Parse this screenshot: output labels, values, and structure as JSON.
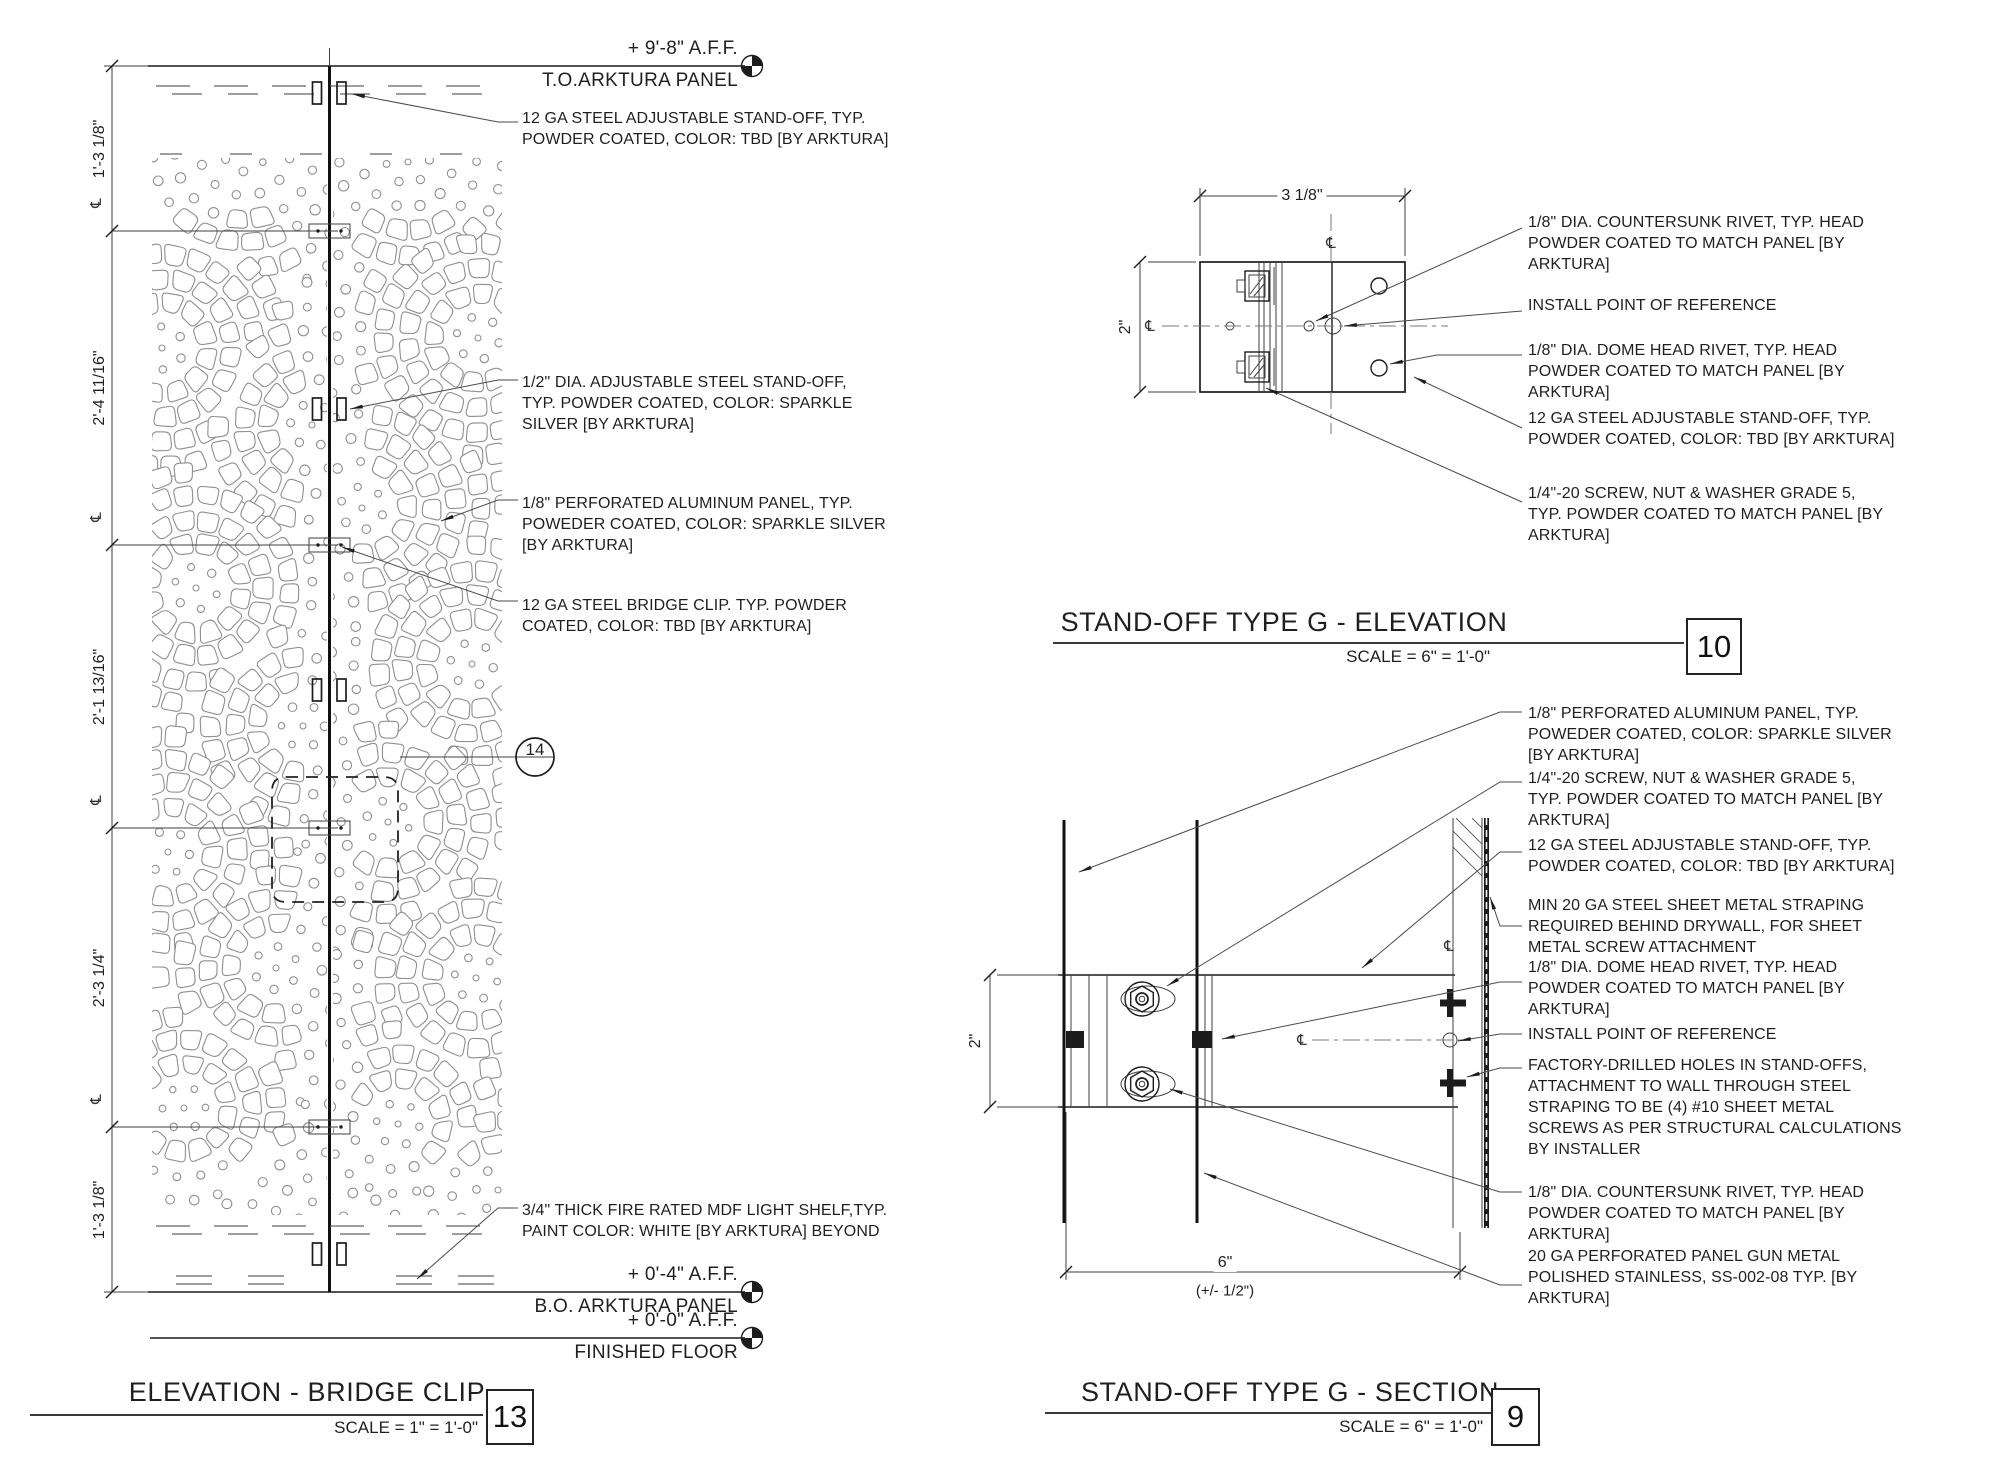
{
  "symbols": {
    "centerline": "℄"
  },
  "bridge_clip": {
    "title": "ELEVATION - BRIDGE CLIP",
    "scale": "SCALE = 1\" = 1'-0\"",
    "number": "13",
    "detail_bubble": "14",
    "levels": [
      {
        "elevation": "+ 9'-8\" A.F.F.",
        "label": "T.O.ARKTURA PANEL"
      },
      {
        "elevation": "+ 0'-4\" A.F.F.",
        "label": "B.O. ARKTURA PANEL"
      },
      {
        "elevation": "+ 0'-0\" A.F.F.",
        "label": "FINISHED FLOOR"
      }
    ],
    "dims": [
      "1'-3 1/8\"",
      "2'-4 11/16\"",
      "2'-1 13/16\"",
      "2'-3 1/4\"",
      "1'-3 1/8\""
    ],
    "notes": [
      "12 GA STEEL ADJUSTABLE STAND-OFF, TYP.\nPOWDER COATED, COLOR: TBD [BY ARKTURA]",
      "1/2\" DIA. ADJUSTABLE STEEL STAND-OFF,\nTYP. POWDER COATED, COLOR: SPARKLE\nSILVER [BY ARKTURA]",
      "1/8\" PERFORATED ALUMINUM PANEL, TYP.\nPOWEDER COATED, COLOR: SPARKLE SILVER\n[BY ARKTURA]",
      "12 GA STEEL BRIDGE CLIP. TYP. POWDER\nCOATED, COLOR: TBD [BY ARKTURA]",
      "3/4\" THICK FIRE RATED MDF LIGHT SHELF,TYP.\nPAINT COLOR: WHITE [BY ARKTURA] BEYOND"
    ]
  },
  "standoff_elevation": {
    "title": "STAND-OFF TYPE G - ELEVATION",
    "scale": "SCALE = 6\" = 1'-0\"",
    "number": "10",
    "dims": {
      "width": "3 1/8\"",
      "height": "2\""
    },
    "notes": [
      "1/8\" DIA. COUNTERSUNK RIVET, TYP. HEAD\nPOWDER COATED TO MATCH PANEL [BY\nARKTURA]",
      "INSTALL POINT OF REFERENCE",
      "1/8\" DIA. DOME HEAD RIVET, TYP. HEAD\nPOWDER COATED TO MATCH PANEL [BY\nARKTURA]",
      "12 GA STEEL ADJUSTABLE STAND-OFF, TYP.\nPOWDER COATED, COLOR: TBD [BY ARKTURA]",
      "1/4\"-20 SCREW, NUT & WASHER GRADE 5,\nTYP. POWDER COATED TO MATCH PANEL [BY\nARKTURA]"
    ]
  },
  "standoff_section": {
    "title": "STAND-OFF TYPE G - SECTION",
    "scale": "SCALE = 6\" = 1'-0\"",
    "number": "9",
    "dims": {
      "height": "2\"",
      "width": "6\"",
      "tolerance": "(+/- 1/2\")"
    },
    "notes": [
      "1/8\" PERFORATED ALUMINUM PANEL, TYP.\nPOWEDER COATED, COLOR: SPARKLE SILVER\n[BY ARKTURA]",
      "1/4\"-20 SCREW, NUT & WASHER GRADE 5,\nTYP. POWDER COATED TO MATCH PANEL [BY\nARKTURA]",
      "12 GA STEEL ADJUSTABLE STAND-OFF, TYP.\nPOWDER COATED, COLOR: TBD [BY ARKTURA]",
      "MIN 20 GA STEEL SHEET METAL STRAPING\nREQUIRED BEHIND DRYWALL, FOR SHEET\nMETAL SCREW ATTACHMENT",
      "1/8\" DIA. DOME HEAD RIVET, TYP. HEAD\nPOWDER COATED TO MATCH PANEL [BY\nARKTURA]",
      "INSTALL POINT OF REFERENCE",
      "FACTORY-DRILLED HOLES IN STAND-OFFS,\nATTACHMENT TO WALL THROUGH STEEL\nSTRAPING TO BE (4) #10 SHEET METAL\nSCREWS AS PER STRUCTURAL CALCULATIONS\nBY INSTALLER",
      "1/8\" DIA. COUNTERSUNK RIVET, TYP. HEAD\nPOWDER COATED TO MATCH PANEL [BY\nARKTURA]",
      "20 GA PERFORATED PANEL GUN METAL\nPOLISHED STAINLESS, SS-002-08 TYP. [BY\nARKTURA]"
    ]
  }
}
